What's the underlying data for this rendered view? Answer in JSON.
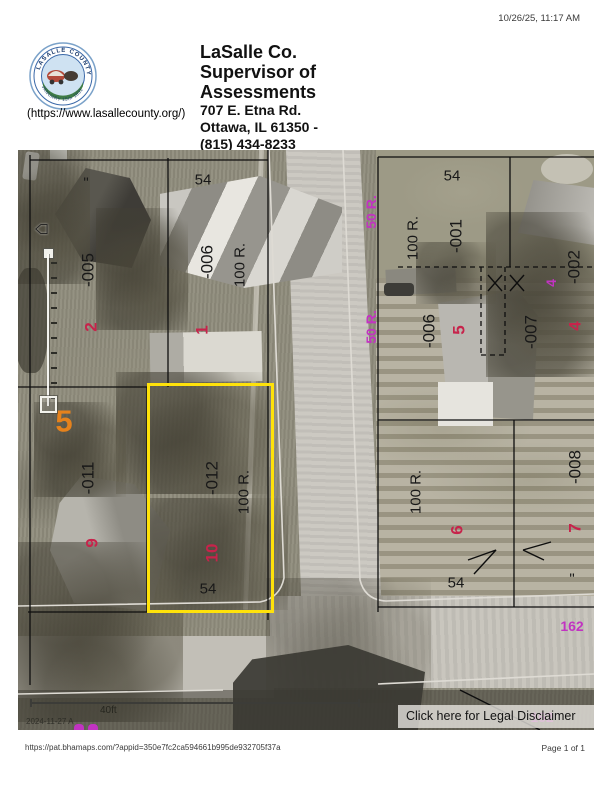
{
  "print": {
    "timestamp": "10/26/25, 11:17 AM",
    "url": "https://pat.bhamaps.com/?appid=350e7fc2ca594661b995de932705f37a",
    "page": "Page 1 of 1"
  },
  "header": {
    "site_link": "(https://www.lasallecounty.org/)",
    "org_line1": "LaSalle Co.",
    "org_line2": "Supervisor of",
    "org_line3": "Assessments",
    "address_line1": "707 E. Etna Rd.",
    "address_line2": "Ottawa, IL 61350 -",
    "address_line3": "(815) 434-8233",
    "seal": {
      "ring_text_top": "LASALLE COUNTY",
      "ring_text_bottom": "JANUARY 15th 1831"
    }
  },
  "map": {
    "disclaimer_label": "Click here for Legal Disclaimer",
    "scale_label": "40ft",
    "imagery_date": "2024-11-27 A",
    "colors": {
      "parcel_highlight": "#ffe20a",
      "lot_number_red": "#c7234b",
      "road_label_magenta": "#c233c2",
      "block_number_orange": "#e6821c",
      "parcel_text_black": "#181818"
    },
    "labels": [
      {
        "text": "54",
        "x": 185,
        "y": 30,
        "rot": 0,
        "role": "dim"
      },
      {
        "text": "\"",
        "x": 68,
        "y": 33,
        "rot": 0,
        "role": "dim"
      },
      {
        "text": "-005",
        "x": 70,
        "y": 120,
        "rot": -90,
        "role": "parcel"
      },
      {
        "text": "-006",
        "x": 189,
        "y": 112,
        "rot": -90,
        "role": "parcel"
      },
      {
        "text": "100 R.",
        "x": 222,
        "y": 115,
        "rot": -90,
        "role": "dim"
      },
      {
        "text": "2",
        "x": 73,
        "y": 177,
        "rot": -90,
        "role": "lot"
      },
      {
        "text": "1",
        "x": 184,
        "y": 180,
        "rot": -90,
        "role": "lot"
      },
      {
        "text": "5",
        "x": 46,
        "y": 271,
        "rot": 0,
        "role": "block"
      },
      {
        "text": "-011",
        "x": 70,
        "y": 328,
        "rot": -90,
        "role": "parcel"
      },
      {
        "text": "9",
        "x": 74,
        "y": 393,
        "rot": -90,
        "role": "lot"
      },
      {
        "text": "-012",
        "x": 194,
        "y": 328,
        "rot": -90,
        "role": "parcel"
      },
      {
        "text": "100 R.",
        "x": 226,
        "y": 342,
        "rot": -90,
        "role": "dim"
      },
      {
        "text": "10",
        "x": 194,
        "y": 403,
        "rot": -90,
        "role": "lot"
      },
      {
        "text": "54",
        "x": 190,
        "y": 439,
        "rot": 0,
        "role": "dim"
      },
      {
        "text": "50 R.",
        "x": 353,
        "y": 62,
        "rot": -90,
        "role": "road"
      },
      {
        "text": "50 R.",
        "x": 353,
        "y": 177,
        "rot": -90,
        "role": "road"
      },
      {
        "text": "54",
        "x": 434,
        "y": 26,
        "rot": 0,
        "role": "dim"
      },
      {
        "text": "100 R.",
        "x": 395,
        "y": 88,
        "rot": -90,
        "role": "dim"
      },
      {
        "text": "-001",
        "x": 438,
        "y": 86,
        "rot": -90,
        "role": "parcel"
      },
      {
        "text": "-002",
        "x": 556,
        "y": 117,
        "rot": -90,
        "role": "parcel"
      },
      {
        "text": "4",
        "x": 533,
        "y": 133,
        "rot": -90,
        "role": "road"
      },
      {
        "text": "4",
        "x": 557,
        "y": 176,
        "rot": -90,
        "role": "lot"
      },
      {
        "text": "-007",
        "x": 513,
        "y": 182,
        "rot": -90,
        "role": "parcel"
      },
      {
        "text": "-006",
        "x": 411,
        "y": 181,
        "rot": -90,
        "role": "parcel"
      },
      {
        "text": "5",
        "x": 441,
        "y": 180,
        "rot": -90,
        "role": "lot"
      },
      {
        "text": "100 R.",
        "x": 398,
        "y": 342,
        "rot": -90,
        "role": "dim"
      },
      {
        "text": "6",
        "x": 439,
        "y": 380,
        "rot": -90,
        "role": "lot"
      },
      {
        "text": "54",
        "x": 438,
        "y": 433,
        "rot": 0,
        "role": "dim"
      },
      {
        "text": "-008",
        "x": 557,
        "y": 317,
        "rot": -90,
        "role": "parcel"
      },
      {
        "text": "7",
        "x": 557,
        "y": 378,
        "rot": -90,
        "role": "lot"
      },
      {
        "text": "\"",
        "x": 554,
        "y": 429,
        "rot": 0,
        "role": "dim"
      },
      {
        "text": "162",
        "x": 554,
        "y": 476,
        "rot": 0,
        "role": "road"
      },
      {
        "text": "162",
        "x": 524,
        "y": 567,
        "rot": 0,
        "role": "road-faint"
      }
    ]
  }
}
